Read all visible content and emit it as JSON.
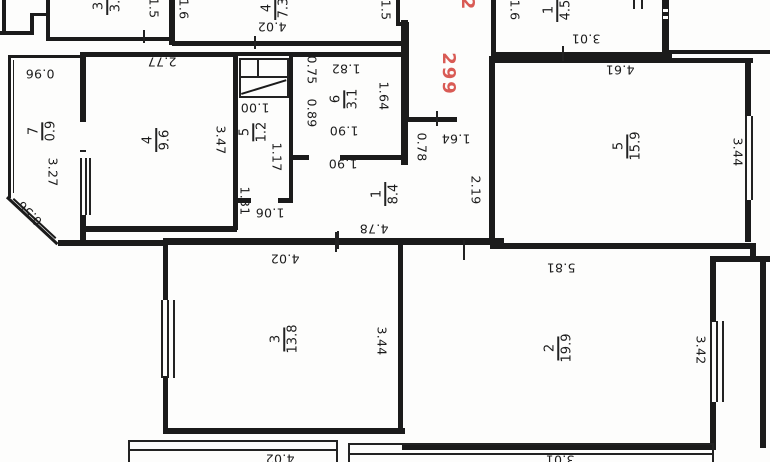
{
  "floor_plan": {
    "unit_number": "299",
    "unit_number_fragment": "2",
    "accent_red": "#d95b55",
    "rooms": [
      {
        "id": "room-top-left",
        "number": "3",
        "area": "3."
      },
      {
        "id": "room-top-center",
        "number": "4",
        "area": "7.3"
      },
      {
        "id": "room-top-right",
        "number": "1",
        "area": "4.5"
      },
      {
        "id": "balcony-left",
        "number": "7",
        "area": "0.9"
      },
      {
        "id": "kitchen",
        "number": "4",
        "area": "9.6"
      },
      {
        "id": "wc",
        "number": "5",
        "area": "1.2"
      },
      {
        "id": "bathroom",
        "number": "6",
        "area": "3.1"
      },
      {
        "id": "hall",
        "number": "1",
        "area": "8.4"
      },
      {
        "id": "bedroom-right",
        "number": "5",
        "area": "15.9"
      },
      {
        "id": "room-bottom-left",
        "number": "3",
        "area": "13.8"
      },
      {
        "id": "room-bottom-right",
        "number": "2",
        "area": "19.9"
      }
    ],
    "dimensions": {
      "w277": "2.77",
      "w402t": "4.02",
      "w301t": "3.01",
      "w096": "0.96",
      "w100": "1.00",
      "w182": "1.82",
      "w190a": "1.90",
      "w190b": "1.90",
      "w164a": "1.64",
      "w478": "4.78",
      "w461": "4.61",
      "w106": "1.06",
      "w402r": "4.02",
      "w581": "5.81",
      "w402b": "4.02",
      "w301b": "3.01",
      "w15a": "1.5",
      "w16a": "1.6",
      "w15b": "1.5",
      "w16b": "1.6",
      "w327": "3.27",
      "w347": "3.47",
      "w117": "1.17",
      "w131": "1.31",
      "w075": "0.75",
      "w089": "0.89",
      "w164b": "1.64",
      "w078": "0.78",
      "w219": "2.19",
      "w344a": "3.44",
      "w344b": "3.44",
      "w342": "3.42",
      "w056": "0.56"
    }
  }
}
